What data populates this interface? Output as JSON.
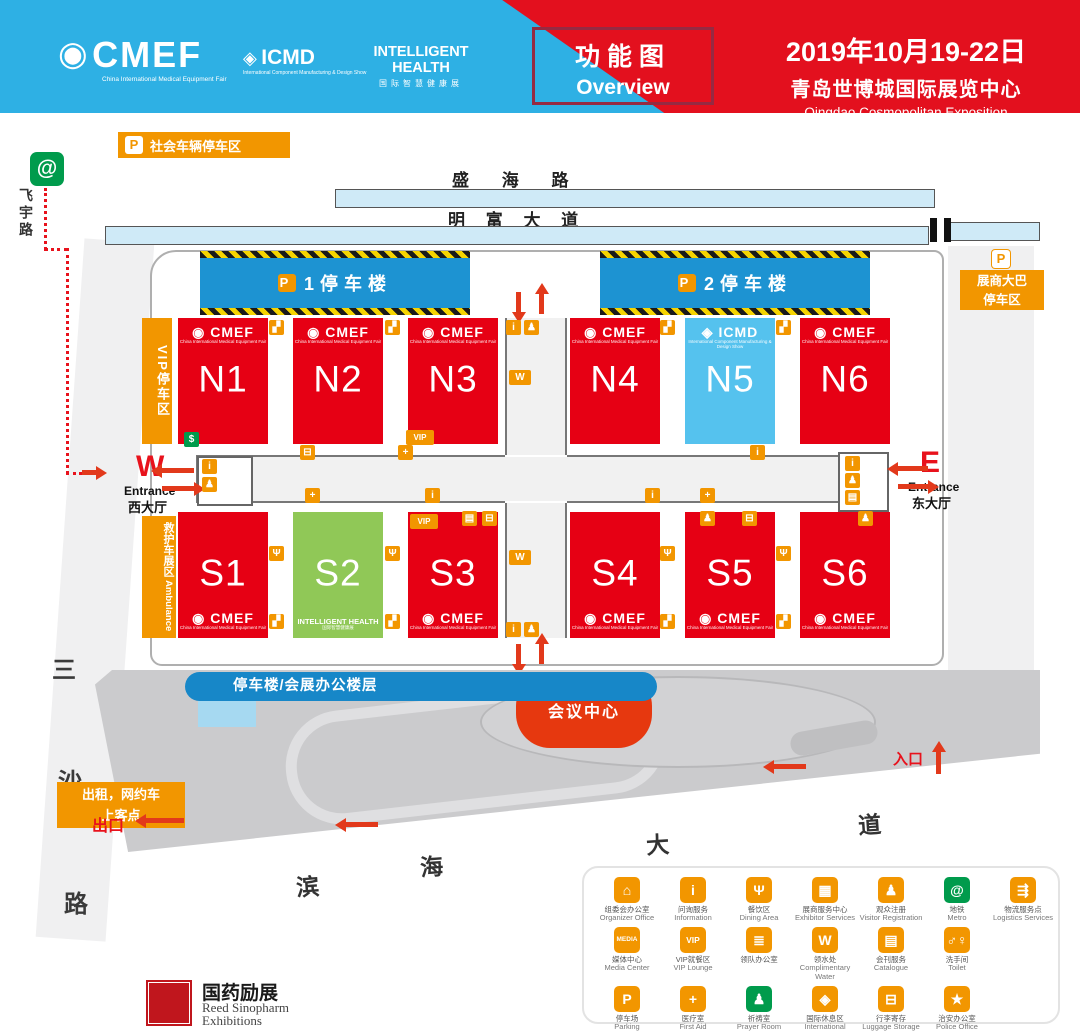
{
  "header": {
    "logos": {
      "cmef": {
        "main": "CMEF",
        "sub": "China International Medical Equipment Fair",
        "emblem": "◉"
      },
      "icmd": {
        "main": "ICMD",
        "sub": "International Component Manufacturing & Design Show",
        "emblem": "◈"
      },
      "ih": {
        "main": "INTELLIGENT HEALTH",
        "sub": "国际智慧健康展",
        "emblem": ""
      }
    },
    "overview_cn": "功能图",
    "overview_en": "Overview",
    "date": "2019年10月19-22日",
    "venue_cn": "青岛世博城国际展览中心",
    "venue_en": "Qingdao Cosmopolitan Exposition"
  },
  "map": {
    "p_letter": "P",
    "social_parking": "社会车辆停车区",
    "roads": {
      "shenghai": "盛 海 路",
      "mingfu": "明 富 大 道",
      "feiyu": "飞宇路",
      "sansha": [
        "三",
        "沙",
        "路"
      ],
      "binhai": [
        "滨",
        "海",
        "大",
        "道"
      ]
    },
    "towers": [
      {
        "label": "1停车楼"
      },
      {
        "label": "2停车楼"
      }
    ],
    "bus_parking": {
      "line1": "展商大巴",
      "line2": "停车区"
    },
    "vip_parking": "VIP停车区",
    "ambulance_cn": "救护车展区",
    "ambulance_en": "Ambulance",
    "west": {
      "letter": "W",
      "en": "Entrance",
      "cn": "西大厅"
    },
    "east": {
      "letter": "E",
      "en": "Entrance",
      "cn": "东大厅"
    },
    "office_pill": "停车楼/会展办公楼层",
    "conference": "会议中心",
    "taxi_line1": "出租，网约车",
    "taxi_line2": "上客点",
    "exit_label": "出口",
    "entry_label": "入口",
    "brands": {
      "cmef": {
        "main": "CMEF",
        "sub": "China International Medical Equipment Fair",
        "emblem": "◉"
      },
      "icmd": {
        "main": "ICMD",
        "sub": "International Component Manufacturing & Design Show",
        "emblem": "◈"
      },
      "ih": {
        "main": "INTELLIGENT HEALTH",
        "sub": "国际智慧健康展",
        "emblem": ""
      }
    },
    "halls": [
      {
        "label": "N1",
        "color": "#E60014",
        "brand": "cmef",
        "pos": "top",
        "x": 178,
        "y": 318,
        "w": 90,
        "h": 126
      },
      {
        "label": "N2",
        "color": "#E60014",
        "brand": "cmef",
        "pos": "top",
        "x": 293,
        "y": 318,
        "w": 90,
        "h": 126
      },
      {
        "label": "N3",
        "color": "#E60014",
        "brand": "cmef",
        "pos": "top",
        "x": 408,
        "y": 318,
        "w": 90,
        "h": 126
      },
      {
        "label": "N4",
        "color": "#E60014",
        "brand": "cmef",
        "pos": "top",
        "x": 570,
        "y": 318,
        "w": 90,
        "h": 126
      },
      {
        "label": "N5",
        "color": "#55C2EE",
        "brand": "icmd",
        "pos": "top",
        "x": 685,
        "y": 318,
        "w": 90,
        "h": 126
      },
      {
        "label": "N6",
        "color": "#E60014",
        "brand": "cmef",
        "pos": "top",
        "x": 800,
        "y": 318,
        "w": 90,
        "h": 126
      },
      {
        "label": "S1",
        "color": "#E60014",
        "brand": "cmef",
        "pos": "bottom",
        "x": 178,
        "y": 512,
        "w": 90,
        "h": 126
      },
      {
        "label": "S2",
        "color": "#90C857",
        "brand": "ih",
        "pos": "bottom",
        "x": 293,
        "y": 512,
        "w": 90,
        "h": 126
      },
      {
        "label": "S3",
        "color": "#E60014",
        "brand": "cmef",
        "pos": "bottom",
        "x": 408,
        "y": 512,
        "w": 90,
        "h": 126
      },
      {
        "label": "S4",
        "color": "#E60014",
        "brand": "cmef",
        "pos": "bottom",
        "x": 570,
        "y": 512,
        "w": 90,
        "h": 126
      },
      {
        "label": "S5",
        "color": "#E60014",
        "brand": "cmef",
        "pos": "bottom",
        "x": 685,
        "y": 512,
        "w": 90,
        "h": 126
      },
      {
        "label": "S6",
        "color": "#E60014",
        "brand": "cmef",
        "pos": "bottom",
        "x": 800,
        "y": 512,
        "w": 90,
        "h": 126
      }
    ],
    "mini_icons": [
      {
        "n": "escalator-icon",
        "g": "▞",
        "x": 269,
        "y": 320
      },
      {
        "n": "escalator-icon",
        "g": "▞",
        "x": 385,
        "y": 320
      },
      {
        "n": "escalator-icon",
        "g": "▞",
        "x": 660,
        "y": 320
      },
      {
        "n": "escalator-icon",
        "g": "▞",
        "x": 776,
        "y": 320
      },
      {
        "n": "info-icon",
        "g": "i",
        "x": 506,
        "y": 320
      },
      {
        "n": "visitor-icon",
        "g": "♟",
        "x": 524,
        "y": 320
      },
      {
        "n": "water-icon",
        "g": "W",
        "x": 509,
        "y": 370,
        "w": 22
      },
      {
        "n": "atm-icon",
        "g": "$",
        "x": 184,
        "y": 432,
        "c": "#009B4C"
      },
      {
        "n": "vip-icon",
        "g": "VIP",
        "x": 406,
        "y": 430,
        "w": 28,
        "fs": 8
      },
      {
        "n": "luggage-icon",
        "g": "⊟",
        "x": 300,
        "y": 445
      },
      {
        "n": "first-aid-icon",
        "g": "+",
        "x": 398,
        "y": 445
      },
      {
        "n": "info-icon",
        "g": "i",
        "x": 750,
        "y": 445
      },
      {
        "n": "info-icon",
        "g": "i",
        "x": 202,
        "y": 459
      },
      {
        "n": "visitor-icon",
        "g": "♟",
        "x": 202,
        "y": 477
      },
      {
        "n": "first-aid-icon",
        "g": "+",
        "x": 305,
        "y": 488
      },
      {
        "n": "info-icon",
        "g": "i",
        "x": 425,
        "y": 488
      },
      {
        "n": "info-icon",
        "g": "i",
        "x": 645,
        "y": 488
      },
      {
        "n": "first-aid-icon",
        "g": "+",
        "x": 700,
        "y": 488
      },
      {
        "n": "info-icon",
        "g": "i",
        "x": 845,
        "y": 456
      },
      {
        "n": "visitor-icon",
        "g": "♟",
        "x": 845,
        "y": 473
      },
      {
        "n": "service-icon",
        "g": "▤",
        "x": 845,
        "y": 490
      },
      {
        "n": "vip-icon",
        "g": "VIP",
        "x": 410,
        "y": 514,
        "w": 28,
        "fs": 8
      },
      {
        "n": "service-icon",
        "g": "▤",
        "x": 462,
        "y": 511
      },
      {
        "n": "luggage-icon",
        "g": "⊟",
        "x": 482,
        "y": 511
      },
      {
        "n": "visitor-icon",
        "g": "♟",
        "x": 700,
        "y": 511
      },
      {
        "n": "luggage-icon",
        "g": "⊟",
        "x": 742,
        "y": 511
      },
      {
        "n": "visitor-icon",
        "g": "♟",
        "x": 858,
        "y": 511
      },
      {
        "n": "dining-icon",
        "g": "Ψ",
        "x": 269,
        "y": 546
      },
      {
        "n": "dining-icon",
        "g": "Ψ",
        "x": 385,
        "y": 546
      },
      {
        "n": "dining-icon",
        "g": "Ψ",
        "x": 660,
        "y": 546
      },
      {
        "n": "dining-icon",
        "g": "Ψ",
        "x": 776,
        "y": 546
      },
      {
        "n": "water-icon",
        "g": "W",
        "x": 509,
        "y": 550,
        "w": 22
      },
      {
        "n": "escalator-icon",
        "g": "▞",
        "x": 269,
        "y": 614
      },
      {
        "n": "escalator-icon",
        "g": "▞",
        "x": 385,
        "y": 614
      },
      {
        "n": "escalator-icon",
        "g": "▞",
        "x": 660,
        "y": 614
      },
      {
        "n": "escalator-icon",
        "g": "▞",
        "x": 776,
        "y": 614
      },
      {
        "n": "info-icon",
        "g": "i",
        "x": 506,
        "y": 622
      },
      {
        "n": "visitor-icon",
        "g": "♟",
        "x": 524,
        "y": 622
      }
    ]
  },
  "legend": {
    "rows": [
      [
        {
          "n": "organizer-office",
          "g": "⌂",
          "cn": "组委会办公室",
          "en": "Organizer Office"
        },
        {
          "n": "information",
          "g": "i",
          "cn": "问询服务",
          "en": "Information"
        },
        {
          "n": "dining-area",
          "g": "Ψ",
          "cn": "餐饮区",
          "en": "Dining Area"
        },
        {
          "n": "exhibitor-services",
          "g": "▦",
          "cn": "展商服务中心",
          "en": "Exhibitor Services"
        },
        {
          "n": "visitor-registration",
          "g": "♟",
          "cn": "观众注册",
          "en": "Visitor Registration"
        },
        {
          "n": "metro",
          "g": "@",
          "bg": "green",
          "cn": "地铁",
          "en": "Metro"
        },
        {
          "n": "logistics-services",
          "g": "⇶",
          "cn": "物流服务点",
          "en": "Logistics Services"
        }
      ],
      [
        {
          "n": "media-center",
          "g": "MEDIA",
          "cn": "媒体中心",
          "en": "Media Center"
        },
        {
          "n": "vip-lounge",
          "g": "VIP",
          "cn": "VIP就餐区",
          "en": "VIP Lounge"
        },
        {
          "n": "leader-office",
          "g": "≣",
          "cn": "领队办公室",
          "en": ""
        },
        {
          "n": "complimentary-water",
          "g": "W",
          "cn": "领水处",
          "en": "Complimentary Water"
        },
        {
          "n": "catalogue",
          "g": "▤",
          "cn": "会刊服务",
          "en": "Catalogue"
        },
        {
          "n": "toilet",
          "g": "♂♀",
          "cn": "洗手间",
          "en": "Toilet"
        }
      ],
      [
        {
          "n": "parking",
          "g": "P",
          "cn": "停车场",
          "en": "Parking"
        },
        {
          "n": "first-aid",
          "g": "+",
          "cn": "医疗室",
          "en": "First Aid"
        },
        {
          "n": "prayer-room",
          "g": "♟",
          "bg": "green",
          "cn": "祈祷室",
          "en": "Prayer Room"
        },
        {
          "n": "international-lounge",
          "g": "◈",
          "cn": "国际休息区",
          "en": "International Lounge"
        },
        {
          "n": "luggage-storage",
          "g": "⊟",
          "cn": "行李寄存",
          "en": "Luggage Storage"
        },
        {
          "n": "police-office",
          "g": "★",
          "cn": "治安办公室",
          "en": "Police Office"
        }
      ]
    ]
  },
  "footer": {
    "cn": "国药励展",
    "en1": "Reed Sinopharm",
    "en2": "Exhibitions"
  }
}
